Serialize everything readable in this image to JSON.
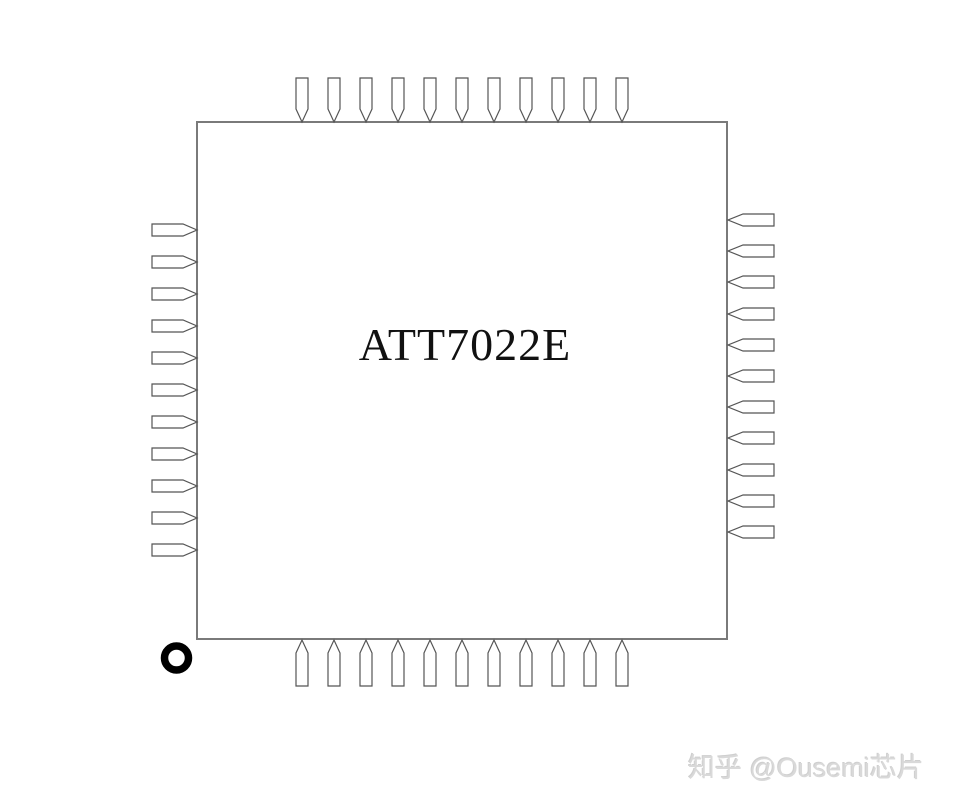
{
  "chip": {
    "title": "ATT7022E",
    "package_pin1_marker": "circle",
    "sides": {
      "top": {
        "order": "left-to-right",
        "pins": [
          {
            "num": "33",
            "label": "GND"
          },
          {
            "num": "32",
            "label": "SLEEP"
          },
          {
            "num": "31",
            "label": "CF4"
          },
          {
            "num": "30",
            "label": "CF3"
          },
          {
            "num": "29",
            "label": "NC"
          },
          {
            "num": "28",
            "label": "CF2"
          },
          {
            "num": "27",
            "label": "CF1"
          },
          {
            "num": "26",
            "label": "SEL"
          },
          {
            "num": "25",
            "label": "NC"
          },
          {
            "num": "24",
            "label": "TEST"
          },
          {
            "num": "23",
            "label": "GND"
          }
        ]
      },
      "left": {
        "order": "top-to-bottom",
        "pins": [
          {
            "num": "34",
            "label": "VCC"
          },
          {
            "num": "35",
            "label": "CS"
          },
          {
            "num": "36",
            "label": "SCLK"
          },
          {
            "num": "37",
            "label": "DIN"
          },
          {
            "num": "38",
            "label": "DOUT"
          },
          {
            "num": "39",
            "label": "VDD"
          },
          {
            "num": "40",
            "label": "REVP"
          },
          {
            "num": "41",
            "label": "VCC"
          },
          {
            "num": "42",
            "label": "OSCI"
          },
          {
            "num": "43",
            "label": "OSCO"
          },
          {
            "num": "44",
            "label": "GND"
          }
        ]
      },
      "right": {
        "order": "top-to-bottom",
        "pins": [
          {
            "num": "22",
            "label": "V0N"
          },
          {
            "num": "21",
            "label": "V0P"
          },
          {
            "num": "20",
            "label": "V6N"
          },
          {
            "num": "19",
            "label": "V6P"
          },
          {
            "num": "18",
            "label": "AVCC"
          },
          {
            "num": "17",
            "label": "V4N"
          },
          {
            "num": "16",
            "label": "V4P"
          },
          {
            "num": "15",
            "label": "AGND"
          },
          {
            "num": "14",
            "label": "V2N"
          },
          {
            "num": "13",
            "label": "V2P"
          },
          {
            "num": "12",
            "label": "AVCC"
          }
        ]
      },
      "bottom": {
        "order": "left-to-right",
        "pins": [
          {
            "num": "1",
            "label": "RESET"
          },
          {
            "num": "2",
            "label": "IRQ"
          },
          {
            "num": "3",
            "label": "V1P"
          },
          {
            "num": "4",
            "label": "V1N"
          },
          {
            "num": "5",
            "label": "REFCAP"
          },
          {
            "num": "6",
            "label": "V3P"
          },
          {
            "num": "7",
            "label": "V3N"
          },
          {
            "num": "8",
            "label": "AGND"
          },
          {
            "num": "9",
            "label": "V5P"
          },
          {
            "num": "10",
            "label": "V5N"
          },
          {
            "num": "11",
            "label": "AGND"
          }
        ]
      }
    }
  },
  "watermark": {
    "text": "知乎 @Ousemi芯片"
  },
  "colors": {
    "background": "#ffffff",
    "chip_border": "#7a7a7a",
    "pin_outline": "#555555",
    "pin_fill": "#ffffff",
    "text": "#111111",
    "pin1_marker": "#000000",
    "watermark": "#d9d9d9"
  }
}
